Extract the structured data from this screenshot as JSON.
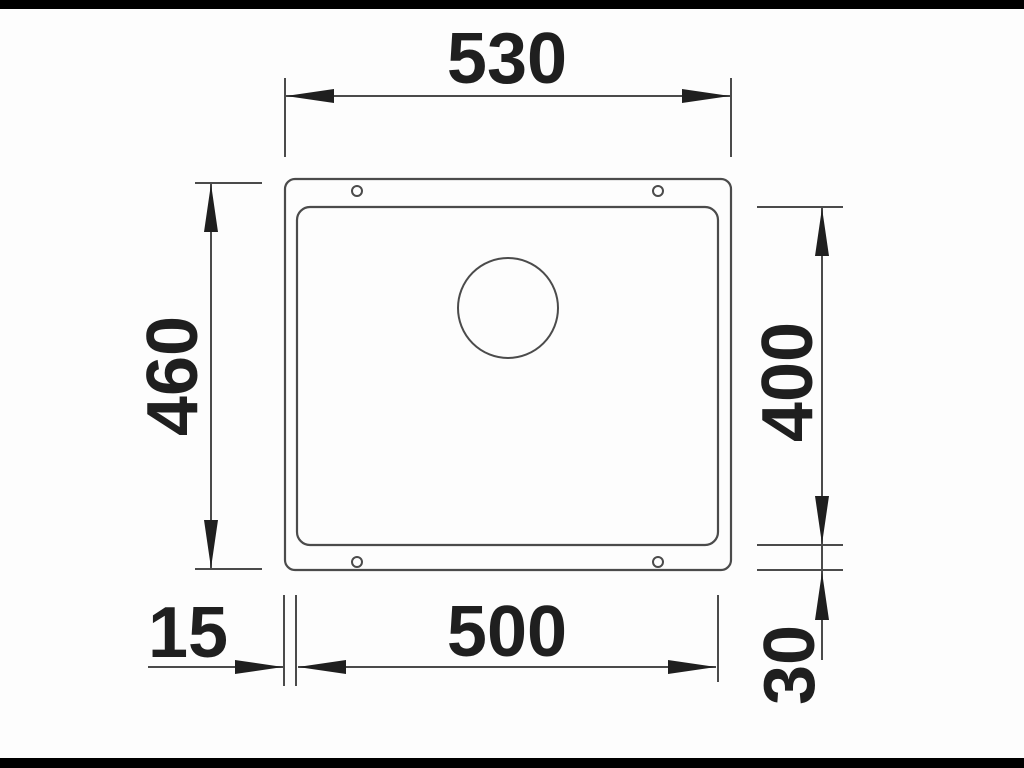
{
  "drawing": {
    "type": "technical-dimension-drawing",
    "subject": "undermount-sink-top-view",
    "dimensions": {
      "top_width": {
        "value": "530",
        "orientation": "horizontal",
        "position": "top"
      },
      "left_height": {
        "value": "460",
        "orientation": "vertical",
        "position": "left"
      },
      "right_height": {
        "value": "400",
        "orientation": "vertical",
        "position": "right"
      },
      "bottom_width": {
        "value": "500",
        "orientation": "horizontal",
        "position": "bottom"
      },
      "bottom_left_offset": {
        "value": "15",
        "orientation": "horizontal",
        "position": "bottom-left"
      },
      "bottom_right_offset": {
        "value": "30",
        "orientation": "vertical",
        "position": "bottom-right"
      }
    },
    "shapes": {
      "outer_rim": "rounded-rectangle",
      "bowl": "rounded-rectangle",
      "drain_hole": "circle",
      "mounting_holes_count": 4
    },
    "colors": {
      "background": "#fdfdfd",
      "letterbox_bar": "#000000",
      "line": "#4b4b4b",
      "arrow_and_text": "#1f1f1f"
    }
  }
}
